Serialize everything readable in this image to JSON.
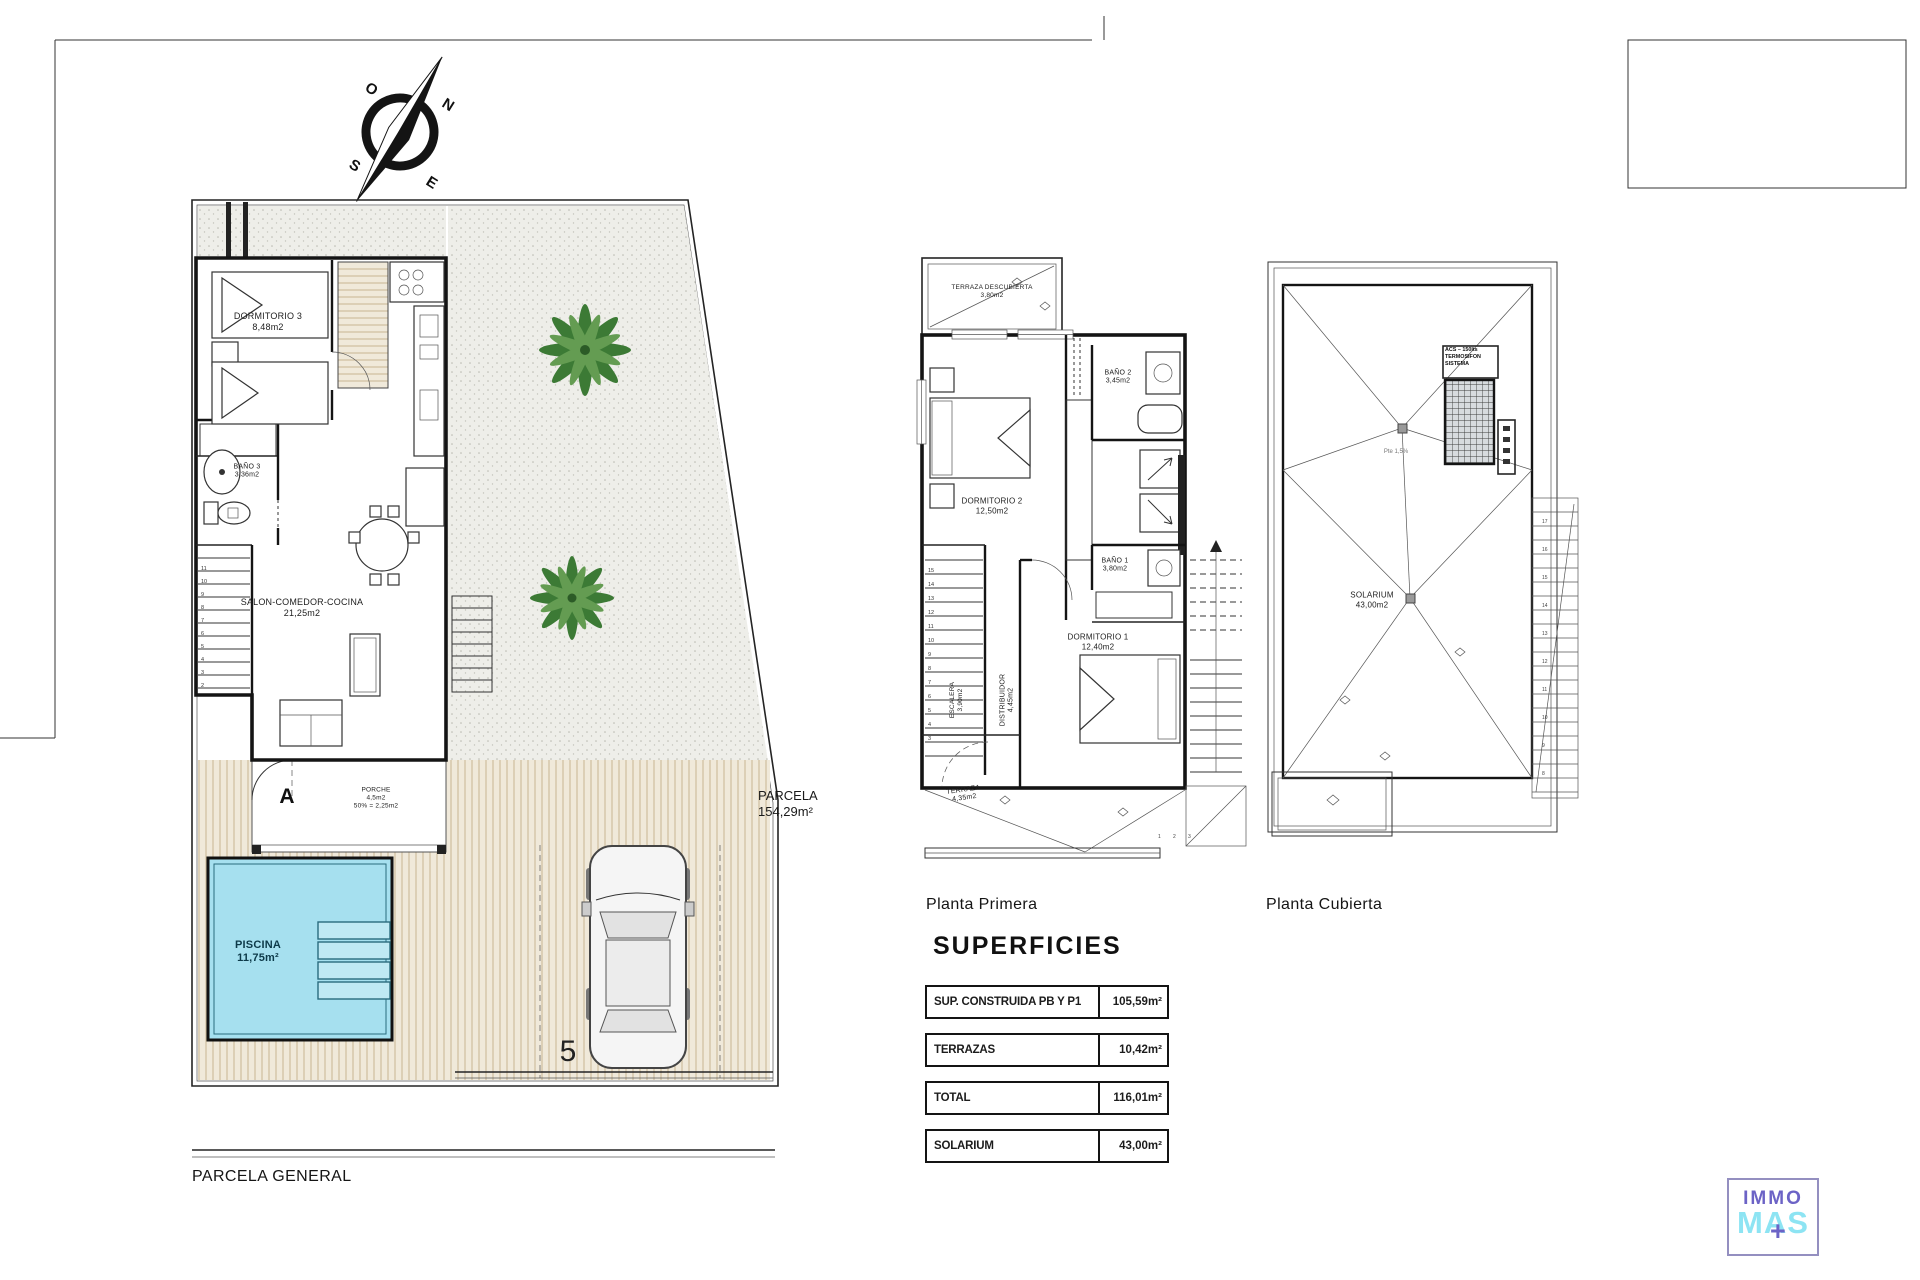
{
  "compass": {
    "n": "N",
    "e": "E",
    "s": "S",
    "o": "O"
  },
  "ground_floor": {
    "caption": "PARCELA GENERAL",
    "dorm3_name": "DORMITORIO 3",
    "dorm3_area": "8,48m2",
    "bano3_name": "BAÑO 3",
    "bano3_area": "3,36m2",
    "salon_name": "SALON-COMEDOR-COCINA",
    "salon_area": "21,25m2",
    "porche_name": "PORCHE",
    "porche_area": "4,5m2",
    "porche_note": "50% = 2,25m2",
    "marker": "A",
    "piscina_name": "PISCINA",
    "piscina_area": "11,75m²",
    "parcela_name": "PARCELA",
    "parcela_area": "154,29m²",
    "plot_number": "5",
    "stairs": [
      "2",
      "3",
      "4",
      "5",
      "6",
      "7",
      "8",
      "9",
      "10",
      "11"
    ]
  },
  "first_floor": {
    "caption": "Planta Primera",
    "terraza_desc_name": "TERRAZA DESCUBIERTA",
    "terraza_desc_area": "3,80m2",
    "bano2_name": "BAÑO 2",
    "bano2_area": "3,45m2",
    "dorm2_name": "DORMITORIO 2",
    "dorm2_area": "12,50m2",
    "bano1_name": "BAÑO 1",
    "bano1_area": "3,80m2",
    "dorm1_name": "DORMITORIO 1",
    "dorm1_area": "12,40m2",
    "escalera_name": "ESCALERA",
    "escalera_area": "3,90m2",
    "distribuidor_name": "DISTRIBUIDOR",
    "distribuidor_area": "4,45m2",
    "terraza_name": "TERRAZA",
    "terraza_area": "4,35m2",
    "stairs": [
      "15",
      "14",
      "13",
      "12",
      "11",
      "10",
      "9",
      "8",
      "7",
      "6",
      "5",
      "4",
      "3"
    ],
    "steps": [
      "1",
      "2",
      "3"
    ]
  },
  "roof": {
    "caption": "Planta Cubierta",
    "solarium_name": "SOLARIUM",
    "solarium_area": "43,00m2",
    "acs_line1": "ACS – 150lts",
    "acs_line2": "TERMOSIFON",
    "acs_line3": "SISTEMA",
    "slope": "Pte 1,5%",
    "stairs": [
      "17",
      "16",
      "15",
      "14",
      "13",
      "12",
      "11",
      "10",
      "9",
      "8"
    ]
  },
  "superficies": {
    "title": "SUPERFICIES",
    "rows": [
      {
        "label": "SUP. CONSTRUIDA PB Y P1",
        "value": "105,59m²"
      },
      {
        "label": "TERRAZAS",
        "value": "10,42m²"
      },
      {
        "label": "TOTAL",
        "value": "116,01m²"
      },
      {
        "label": "SOLARIUM",
        "value": "43,00m²"
      }
    ]
  },
  "logo": {
    "top": "IMMO",
    "bottom": "MAS",
    "plus": "+"
  },
  "colors": {
    "pool": "#a6e0ef",
    "tree": "#3c7a35",
    "logo_purple": "#6c63c6",
    "logo_cyan": "#8de4f3"
  }
}
